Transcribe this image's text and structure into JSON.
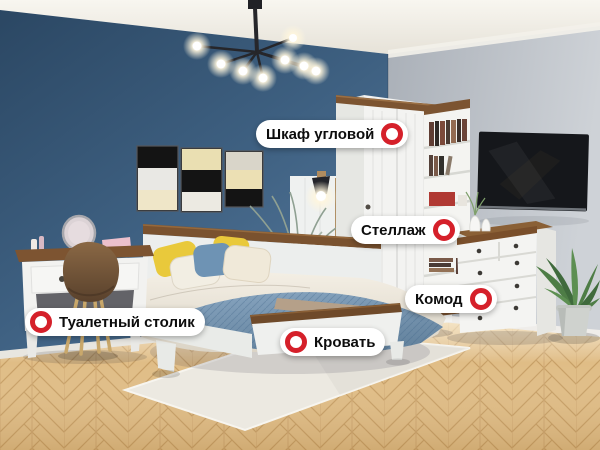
{
  "hotspots": [
    {
      "label": "Шкаф угловой"
    },
    {
      "label": "Стеллаж"
    },
    {
      "label": "Комод"
    },
    {
      "label": "Кровать"
    },
    {
      "label": "Туалетный столик"
    }
  ],
  "colors": {
    "marker_red": "#d5202a",
    "pill_background": "#ffffff",
    "pill_text": "#0d0d0d",
    "wall_blue": "#3e6081",
    "wall_gray": "#c0c5cb",
    "floor_wood": "#e0bd86",
    "blanket_blue": "#7699b5",
    "pillow_yellow": "#e9c93b"
  }
}
